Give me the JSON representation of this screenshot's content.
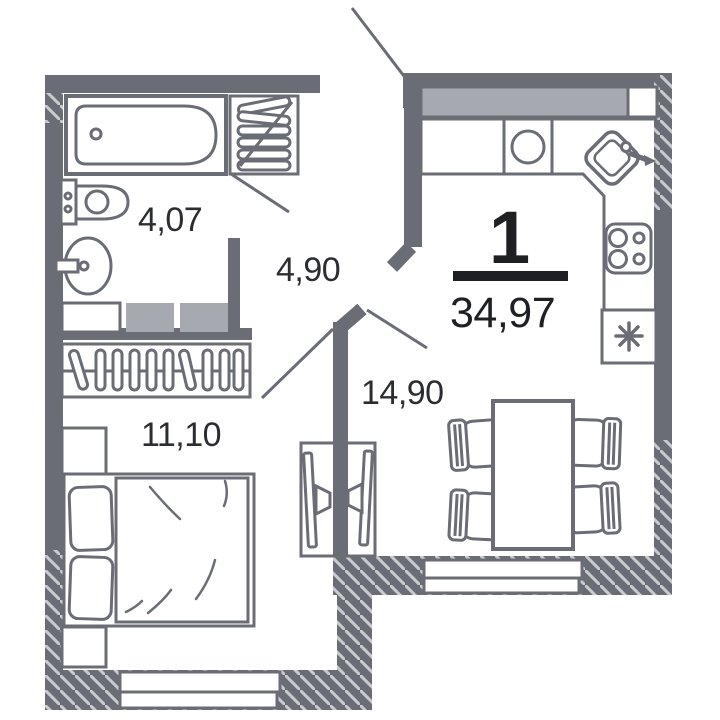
{
  "plan": {
    "type": "floor-plan",
    "rooms_count": "1",
    "total_area": "34,97",
    "rooms": [
      {
        "id": "bathroom",
        "area": "4,07"
      },
      {
        "id": "hallway",
        "area": "4,90"
      },
      {
        "id": "bedroom",
        "area": "11,10"
      },
      {
        "id": "living-kitchen",
        "area": "14,90"
      }
    ]
  },
  "colors": {
    "wall": "#6b6d76",
    "cabinet_fill": "#a7a9b0",
    "hatch_line": "#c9cbce",
    "label_text": "#2c2d31",
    "headline_text": "#1f2024",
    "background": "#ffffff"
  },
  "symbols": [
    "bathtub-icon",
    "towel-radiator-icon",
    "toilet-icon",
    "washbasin-icon",
    "washer-cabinet-icon",
    "wardrobe-hangers-icon",
    "nightstand-icon",
    "double-bed-icon",
    "tv-unit-icon",
    "dining-table-icon",
    "chair-icon",
    "kitchen-cabinets-icon",
    "round-sink-icon",
    "corner-sink-icon",
    "stove-icon",
    "fridge-snowflake-icon",
    "window-icon",
    "door-leaf-icon"
  ]
}
